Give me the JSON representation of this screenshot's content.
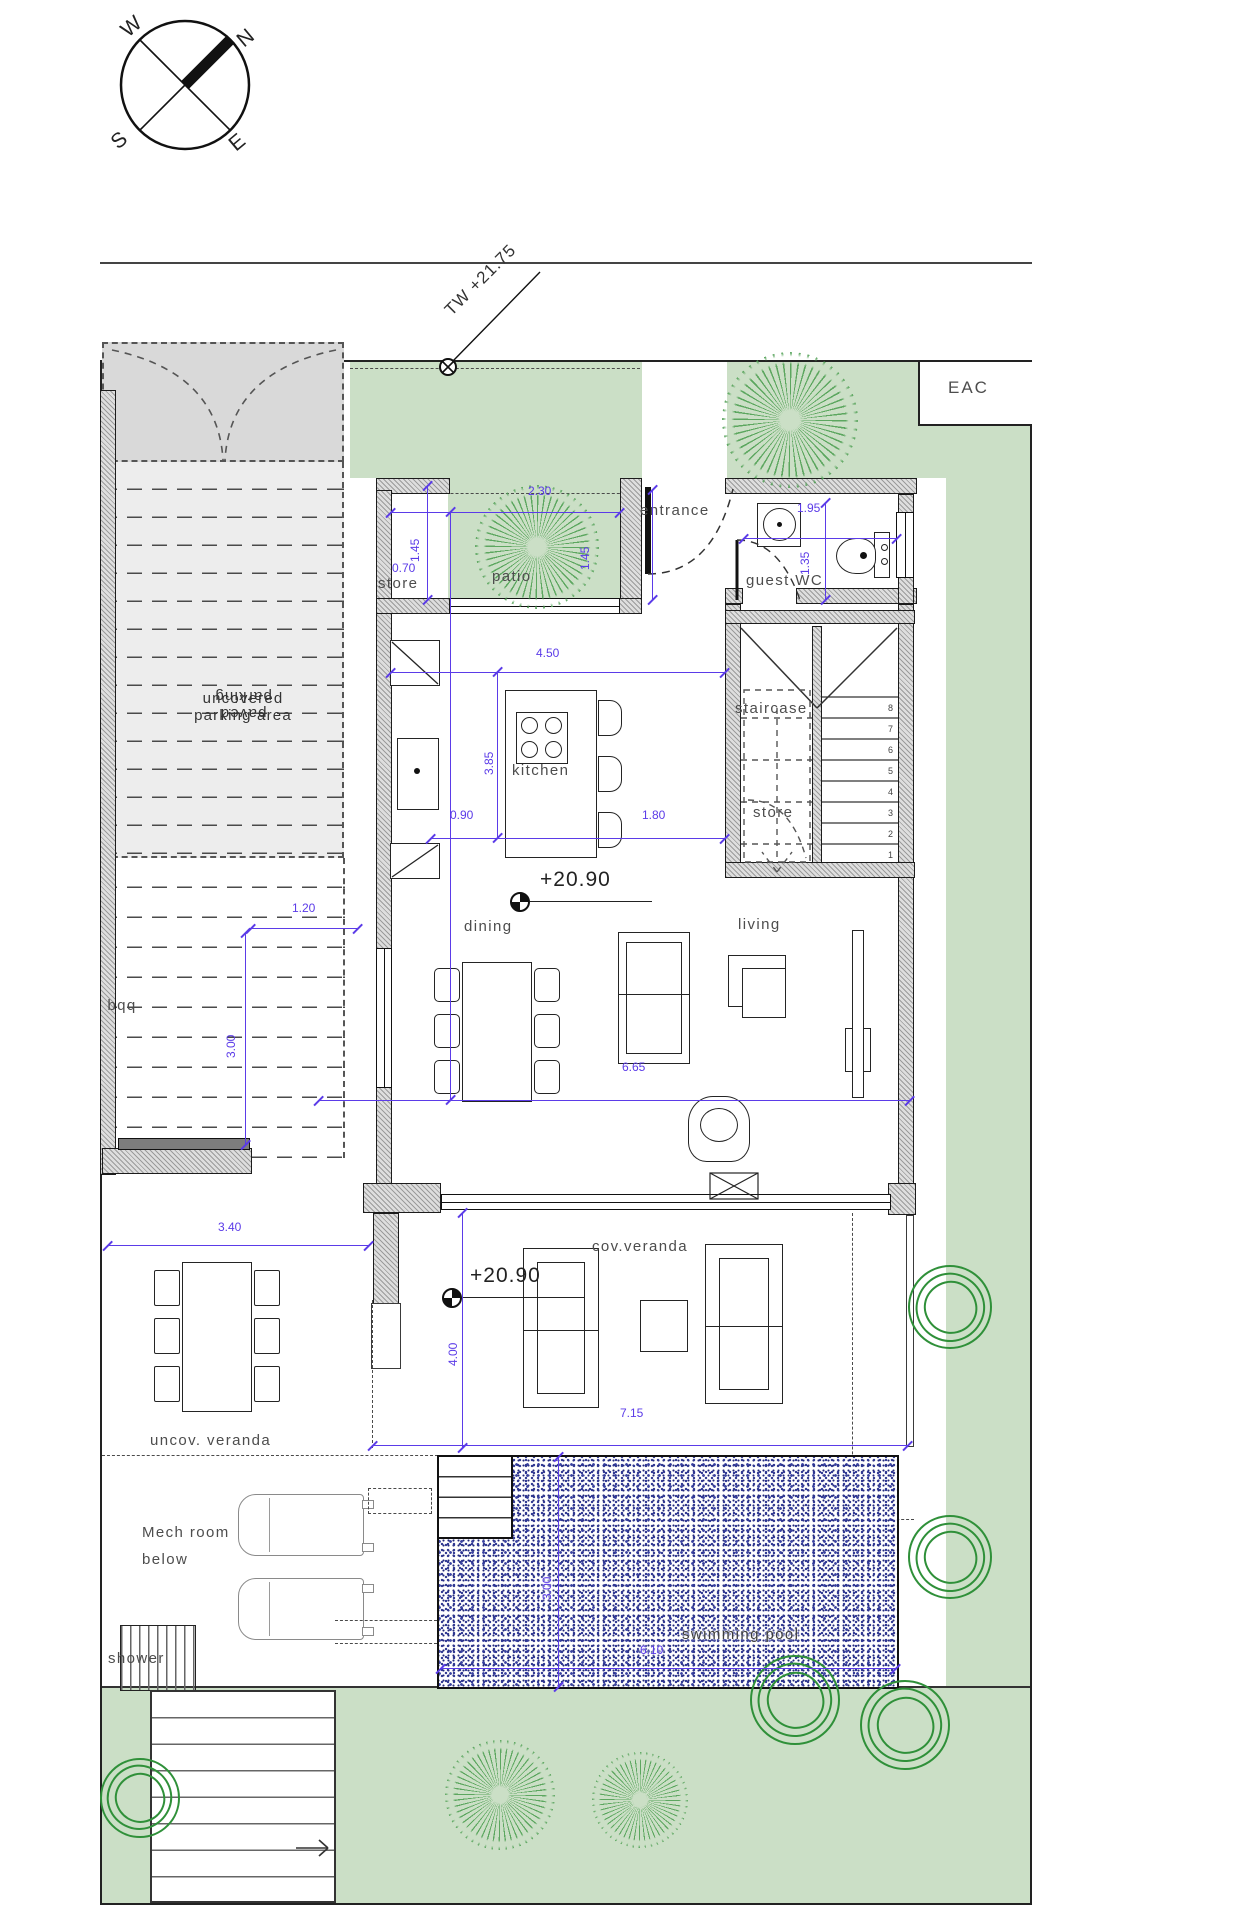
{
  "compass": {
    "n": "N",
    "w": "W",
    "s": "S",
    "e": "E"
  },
  "annotations": {
    "tw_level": "TW +21.75",
    "eac": "EAC"
  },
  "levels": {
    "main": "+20.90",
    "veranda": "+20.90"
  },
  "rooms": {
    "store_top": "store",
    "patio": "patio",
    "entrance": "entrance",
    "guest_wc": "guest WC",
    "staircase": "staircase",
    "stair_store": "store",
    "kitchen": "kitchen",
    "dining": "dining",
    "living": "living",
    "bbq": "bbq",
    "cov_veranda": "cov.veranda",
    "uncov_veranda": "uncov. veranda",
    "mech_line1": "Mech room",
    "mech_line2": "below",
    "shower": "shower",
    "pool": "swimming pool"
  },
  "parking": {
    "line1": "uncovered",
    "line2": "parking area",
    "flip1": "paved",
    "flip2": "parking"
  },
  "dims": {
    "patio_width": "2.30",
    "store_width": "0.70",
    "store_depth": "1.45",
    "patio_depth": "1.45",
    "wc_width": "1.95",
    "wc_depth": "1.35",
    "kitchen_width": "4.50",
    "kitchen_depth": "3.85",
    "island_offset": "0.90",
    "island_clear": "1.80",
    "bbq_offset": "1.20",
    "bbq_depth": "3.00",
    "living_width": "6.65",
    "uncov_veranda_width": "3.40",
    "veranda_depth": "4.00",
    "veranda_width": "7.15",
    "pool_width": "6.10",
    "pool_depth": "3.00"
  },
  "stairs": {
    "steps": [
      "8",
      "7",
      "6",
      "5",
      "4",
      "3",
      "2",
      "1"
    ]
  },
  "colors": {
    "dimension": "#5B3BE8",
    "garden": "#CBDFC6",
    "tree_burst": "#56A35A",
    "tree_scribble": "#2F9039",
    "pool_stipple": "#2E3691"
  }
}
